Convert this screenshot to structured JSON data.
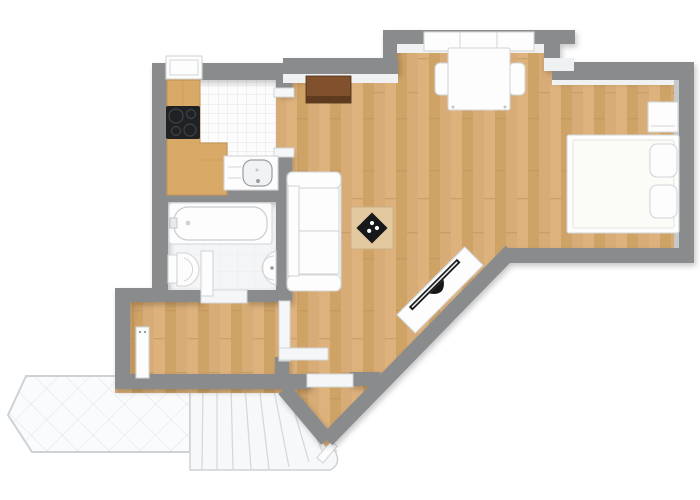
{
  "floorplan": {
    "colors": {
      "background": "#ffffff",
      "wall": "#8a8b8d",
      "wall_face": "#f0f1f2",
      "wall_face_dark": "#c7c8ca",
      "wood_base": "#d7ac76",
      "wood_dark": "#cfa266",
      "wood_light": "#ddb27c",
      "wood_joint": "#bb9260",
      "counter": "#d9a967",
      "counter_edge": "#c39551",
      "tile_bg": "#fcfcfd",
      "tile_line": "#e4e4e6",
      "bath_bg": "#f3f5f6",
      "bath_line": "#e8eaec",
      "terrace_bg": "#fafbfc",
      "terrace_line": "#dfe3e7",
      "terrace_border": "#cdd2d6",
      "stair_bg": "#f7f8f9",
      "stair_line": "#d6d9dc",
      "white_furniture": "#fdfdfd",
      "furniture_outline": "#d3d5d7",
      "appliance_black": "#202124",
      "tv_black": "#17181a",
      "sideboard_top": "#80512c",
      "sideboard_front": "#5e3a1f"
    },
    "rooms": [
      {
        "name": "kitchen"
      },
      {
        "name": "bathroom"
      },
      {
        "name": "hallway"
      },
      {
        "name": "living-dining-area"
      },
      {
        "name": "sleeping-area"
      },
      {
        "name": "entry-vestibule"
      },
      {
        "name": "terrace"
      },
      {
        "name": "staircase"
      }
    ],
    "furniture": [
      "kitchen-counter",
      "cooktop",
      "kitchen-sink",
      "kitchen-window",
      "dining-window",
      "dining-table",
      "dining-chair-left",
      "dining-chair-right",
      "sideboard",
      "sofa",
      "coffee-table",
      "game-board",
      "tv-bench",
      "tv",
      "bed",
      "pillow",
      "nightstand",
      "bathtub",
      "toilet",
      "washbasin",
      "bathroom-door-leaf",
      "radiator-door-leaf",
      "hall-partition",
      "entrance-threshold",
      "terrace-tiles",
      "stair-steps",
      "stair-newel"
    ]
  }
}
